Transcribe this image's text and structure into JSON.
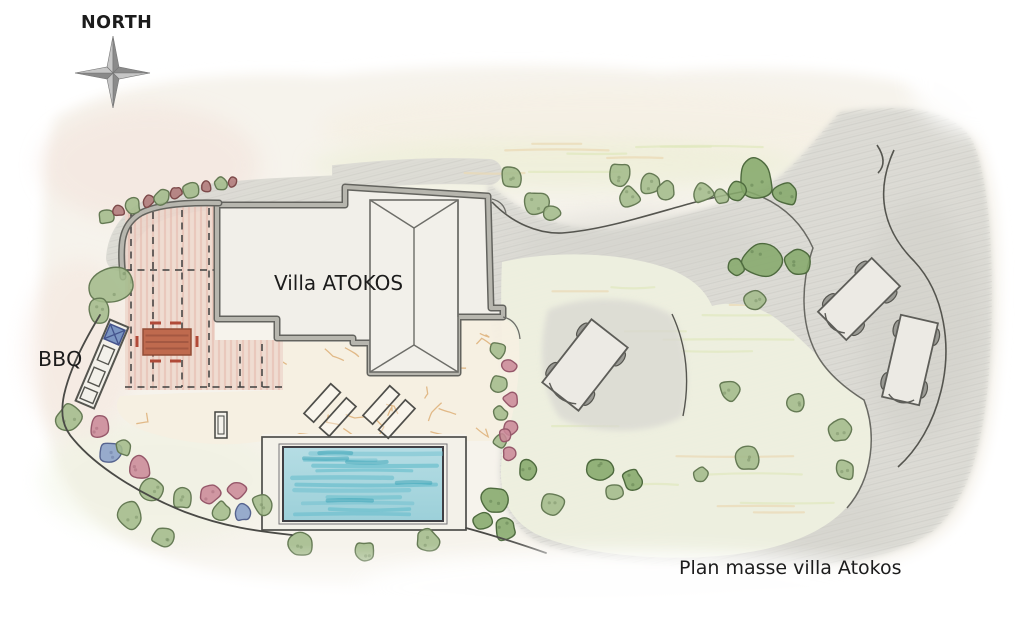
{
  "labels": {
    "north": "NORTH",
    "villa": "Villa ATOKOS",
    "bbq": "BBQ",
    "caption": "Plan masse villa Atokos"
  },
  "palette": {
    "paper": "#f6f3ec",
    "terrain_gray": "#dcdbd5",
    "lawn_green": "#eef0df",
    "pool_water_light": "#b5dde4",
    "pool_water": "#9cd0d9",
    "pool_streak": "#63bccb",
    "pool_streak_dark": "#2e9db2",
    "pergola_pink": "#eed6cb",
    "table_red": "#bf6a4e",
    "wall_gray": "#b7b6ae",
    "wall_edge": "#63635e",
    "line_dark": "#4a4a46",
    "crack_orange": "#dcab70",
    "grass_streak": "#dfe8bd",
    "plant_green": "#a3bb8b",
    "plant_green_edge": "#657a54",
    "plant_dark_green": "#85a86b",
    "plant_dark_green_edge": "#4e6a3e",
    "plant_pink": "#cb8a99",
    "plant_pink_edge": "#96586a",
    "plant_blue": "#8aa0c8",
    "plant_blue_edge": "#56648f",
    "plant_maroon": "#b07a7a",
    "plant_maroon_edge": "#7d4a4a",
    "car_body": "#eceae4",
    "car_edge": "#5d5d58",
    "wheel_gray": "#9a9a94",
    "bbq_blue": "#7b95c2",
    "compass_dark": "#8a8a8a",
    "compass_light": "#c6c6c6"
  },
  "plan": {
    "plants": [
      [
        512,
        177,
        12,
        "g"
      ],
      [
        536,
        203,
        13,
        "g"
      ],
      [
        553,
        213,
        9,
        "g"
      ],
      [
        620,
        175,
        13,
        "g"
      ],
      [
        630,
        197,
        11,
        "g"
      ],
      [
        650,
        184,
        11,
        "g"
      ],
      [
        666,
        190,
        10,
        "g"
      ],
      [
        703,
        193,
        12,
        "g"
      ],
      [
        722,
        197,
        8,
        "g"
      ],
      [
        757,
        178,
        20,
        "d"
      ],
      [
        737,
        191,
        10,
        "d"
      ],
      [
        786,
        193,
        13,
        "d"
      ],
      [
        762,
        258,
        20,
        "d"
      ],
      [
        798,
        262,
        13,
        "d"
      ],
      [
        737,
        268,
        10,
        "d"
      ],
      [
        755,
        300,
        11,
        "g"
      ],
      [
        730,
        391,
        12,
        "g"
      ],
      [
        796,
        403,
        11,
        "g"
      ],
      [
        840,
        430,
        12,
        "g"
      ],
      [
        748,
        458,
        13,
        "g"
      ],
      [
        845,
        470,
        11,
        "g"
      ],
      [
        700,
        475,
        9,
        "g"
      ],
      [
        495,
        500,
        16,
        "d"
      ],
      [
        505,
        528,
        12,
        "d"
      ],
      [
        483,
        520,
        10,
        "d"
      ],
      [
        528,
        470,
        11,
        "d"
      ],
      [
        552,
        505,
        12,
        "g"
      ],
      [
        600,
        470,
        15,
        "d"
      ],
      [
        633,
        481,
        12,
        "d"
      ],
      [
        613,
        492,
        10,
        "g"
      ],
      [
        300,
        545,
        13,
        "g"
      ],
      [
        365,
        552,
        11,
        "g"
      ],
      [
        428,
        540,
        12,
        "g"
      ],
      [
        70,
        418,
        15,
        "g"
      ],
      [
        100,
        428,
        12,
        "p"
      ],
      [
        110,
        452,
        12,
        "b"
      ],
      [
        123,
        448,
        9,
        "g"
      ],
      [
        140,
        468,
        13,
        "p"
      ],
      [
        152,
        490,
        12,
        "g"
      ],
      [
        182,
        498,
        11,
        "g"
      ],
      [
        209,
        494,
        12,
        "p"
      ],
      [
        221,
        511,
        10,
        "g"
      ],
      [
        243,
        512,
        10,
        "b"
      ],
      [
        237,
        490,
        10,
        "p"
      ],
      [
        262,
        504,
        11,
        "g"
      ],
      [
        130,
        516,
        14,
        "g"
      ],
      [
        163,
        537,
        11,
        "g"
      ],
      [
        113,
        285,
        23,
        "g"
      ],
      [
        100,
        310,
        12,
        "g"
      ],
      [
        106,
        217,
        8,
        "g"
      ],
      [
        119,
        211,
        6,
        "m"
      ],
      [
        133,
        206,
        8,
        "g"
      ],
      [
        148,
        201,
        6,
        "m"
      ],
      [
        162,
        197,
        8,
        "g"
      ],
      [
        176,
        193,
        6,
        "m"
      ],
      [
        191,
        190,
        8,
        "g"
      ],
      [
        206,
        187,
        6,
        "m"
      ],
      [
        220,
        184,
        7,
        "g"
      ],
      [
        232,
        182,
        5,
        "m"
      ],
      [
        498,
        350,
        9,
        "g"
      ],
      [
        509,
        366,
        8,
        "p"
      ],
      [
        499,
        383,
        9,
        "g"
      ],
      [
        511,
        399,
        8,
        "p"
      ],
      [
        500,
        414,
        8,
        "g"
      ],
      [
        511,
        428,
        8,
        "p"
      ],
      [
        501,
        441,
        8,
        "g"
      ],
      [
        509,
        454,
        7,
        "p"
      ],
      [
        505,
        435,
        7,
        "p"
      ]
    ],
    "cars": [
      [
        585,
        365,
        46,
        80,
        38
      ],
      [
        859,
        299,
        40,
        76,
        45
      ],
      [
        910,
        360,
        38,
        84,
        13
      ]
    ],
    "loungers": [
      [
        330,
        410,
        42
      ],
      [
        389,
        412,
        42
      ]
    ]
  }
}
